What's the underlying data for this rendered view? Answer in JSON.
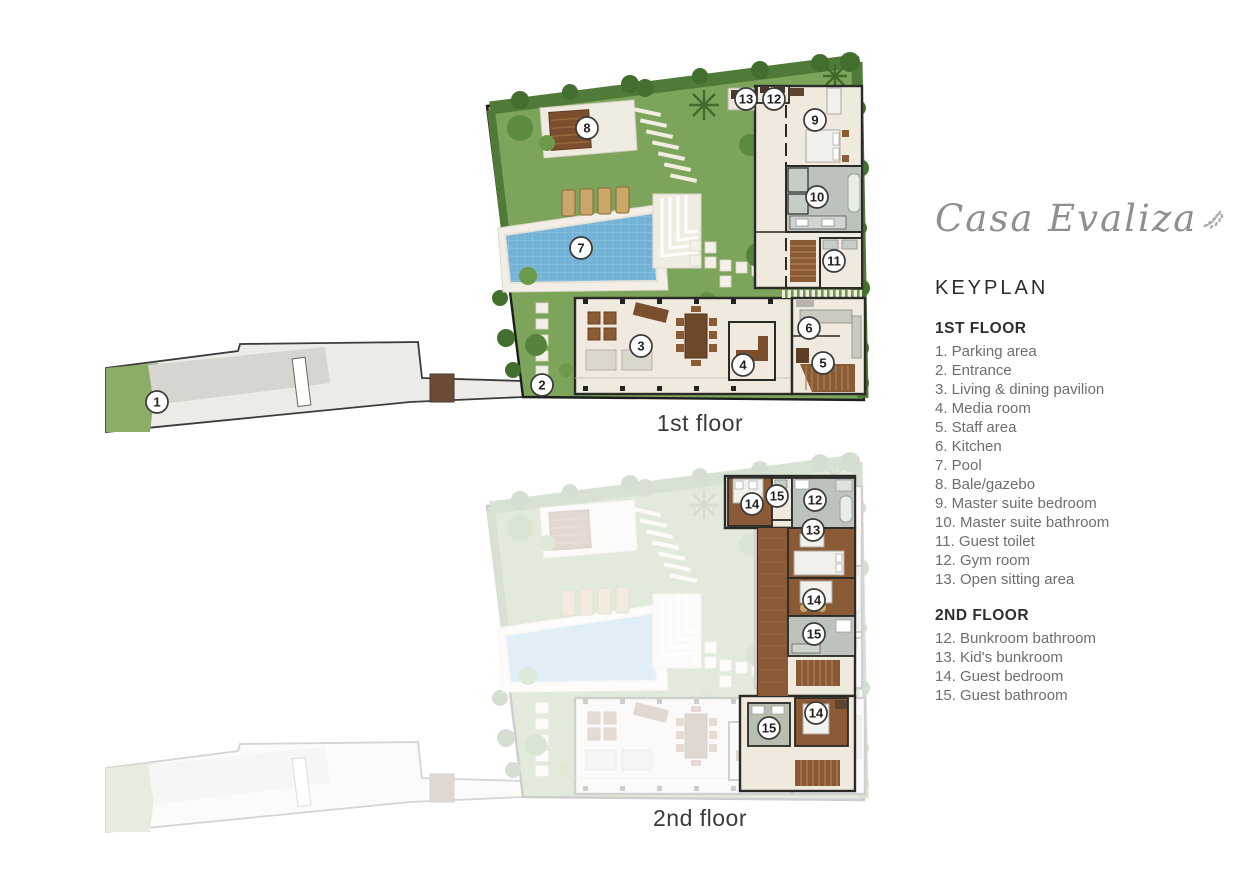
{
  "logo": {
    "text": "Casa Evaliza",
    "icon": "leaf-sprig"
  },
  "keyplan": {
    "title": "KEYPLAN",
    "sections": [
      {
        "heading": "1ST FLOOR",
        "items": [
          "1. Parking area",
          "2. Entrance",
          "3. Living & dining pavilion",
          "4. Media room",
          "5. Staff area",
          "6. Kitchen",
          "7. Pool",
          "8. Bale/gazebo",
          "9. Master suite bedroom",
          "10. Master suite bathroom",
          "11. Guest toilet",
          "12. Gym room",
          "13. Open sitting area"
        ]
      },
      {
        "heading": "2ND FLOOR",
        "items": [
          "12. Bunkroom bathroom",
          "13. Kid's bunkroom",
          "14. Guest bedroom",
          "15. Guest bathroom"
        ]
      }
    ]
  },
  "floors": [
    {
      "label": "1st floor",
      "markers": [
        {
          "n": "1",
          "x": 57,
          "y": 354
        },
        {
          "n": "2",
          "x": 442,
          "y": 337
        },
        {
          "n": "3",
          "x": 541,
          "y": 298
        },
        {
          "n": "4",
          "x": 643,
          "y": 317
        },
        {
          "n": "5",
          "x": 723,
          "y": 315
        },
        {
          "n": "6",
          "x": 709,
          "y": 280
        },
        {
          "n": "7",
          "x": 481,
          "y": 200
        },
        {
          "n": "8",
          "x": 487,
          "y": 80
        },
        {
          "n": "9",
          "x": 715,
          "y": 72
        },
        {
          "n": "10",
          "x": 717,
          "y": 149
        },
        {
          "n": "11",
          "x": 734,
          "y": 213
        },
        {
          "n": "12",
          "x": 674,
          "y": 51
        },
        {
          "n": "13",
          "x": 646,
          "y": 51
        }
      ]
    },
    {
      "label": "2nd floor",
      "markers": [
        {
          "n": "14",
          "x": 652,
          "y": 56
        },
        {
          "n": "15",
          "x": 677,
          "y": 48
        },
        {
          "n": "12",
          "x": 715,
          "y": 52
        },
        {
          "n": "13",
          "x": 713,
          "y": 82
        },
        {
          "n": "14",
          "x": 714,
          "y": 152
        },
        {
          "n": "15",
          "x": 714,
          "y": 186
        },
        {
          "n": "15",
          "x": 669,
          "y": 280
        },
        {
          "n": "14",
          "x": 716,
          "y": 265
        }
      ]
    }
  ],
  "colors": {
    "garden_green": "#7CA45B",
    "hedge_green": "#4F7A38",
    "pool_blue": "#74B3D8",
    "building_cream": "#EFE9DE",
    "wall_dark": "#2A2A26",
    "wood_brown": "#8A5A36",
    "bath_gray": "#BCC3BC",
    "path_gray": "#ECEBE7",
    "legend_text": "#6E6E6E",
    "heading_text": "#2E2E2E",
    "logo_gray": "#8F8F8F"
  }
}
